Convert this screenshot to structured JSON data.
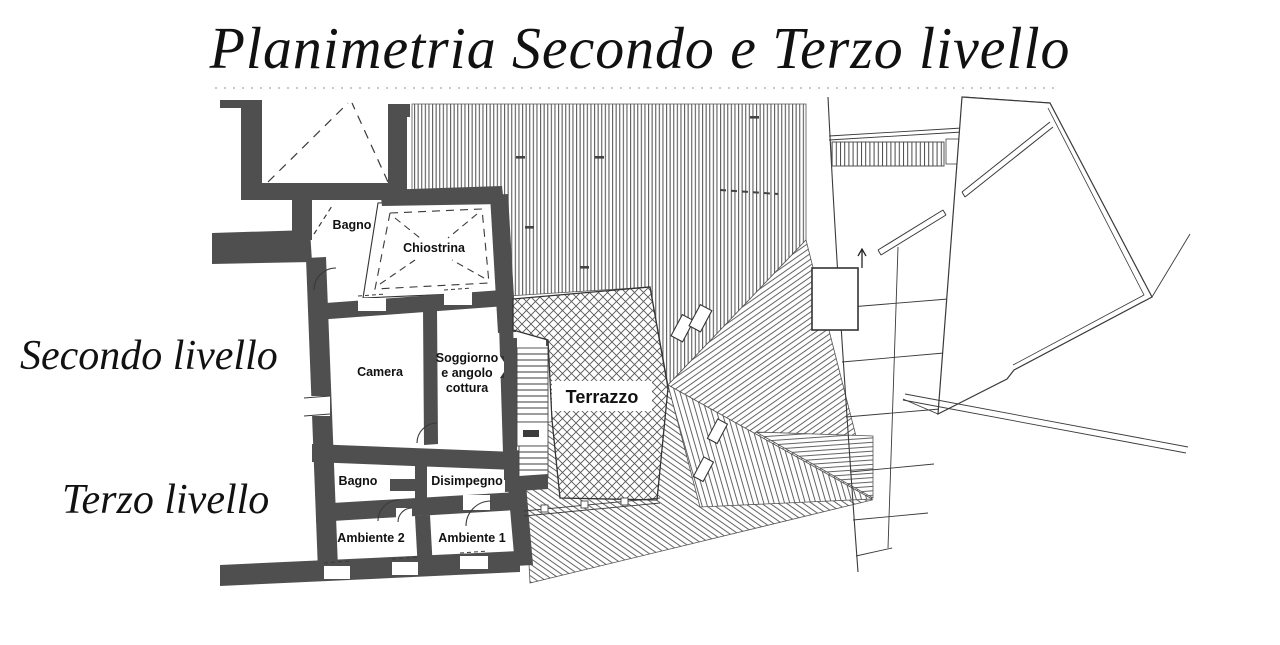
{
  "title": "Planimetria Secondo e Terzo livello",
  "levels": {
    "secondo": "Secondo livello",
    "terzo": "Terzo livello"
  },
  "rooms": {
    "bagno2": "Bagno",
    "chiostrina": "Chiostrina",
    "camera": "Camera",
    "soggiorno_line1": "Soggiorno",
    "soggiorno_line2": "e angolo",
    "soggiorno_line3": "cottura",
    "terrazzo": "Terrazzo",
    "bagno3": "Bagno",
    "disimpegno": "Disimpegno",
    "ambiente2": "Ambiente 2",
    "ambiente1": "Ambiente 1"
  },
  "colors": {
    "wall": "#4f4f4f",
    "line": "#3a3a3a",
    "hatch": "#6a6a6a",
    "background": "#ffffff",
    "text": "#111111"
  }
}
